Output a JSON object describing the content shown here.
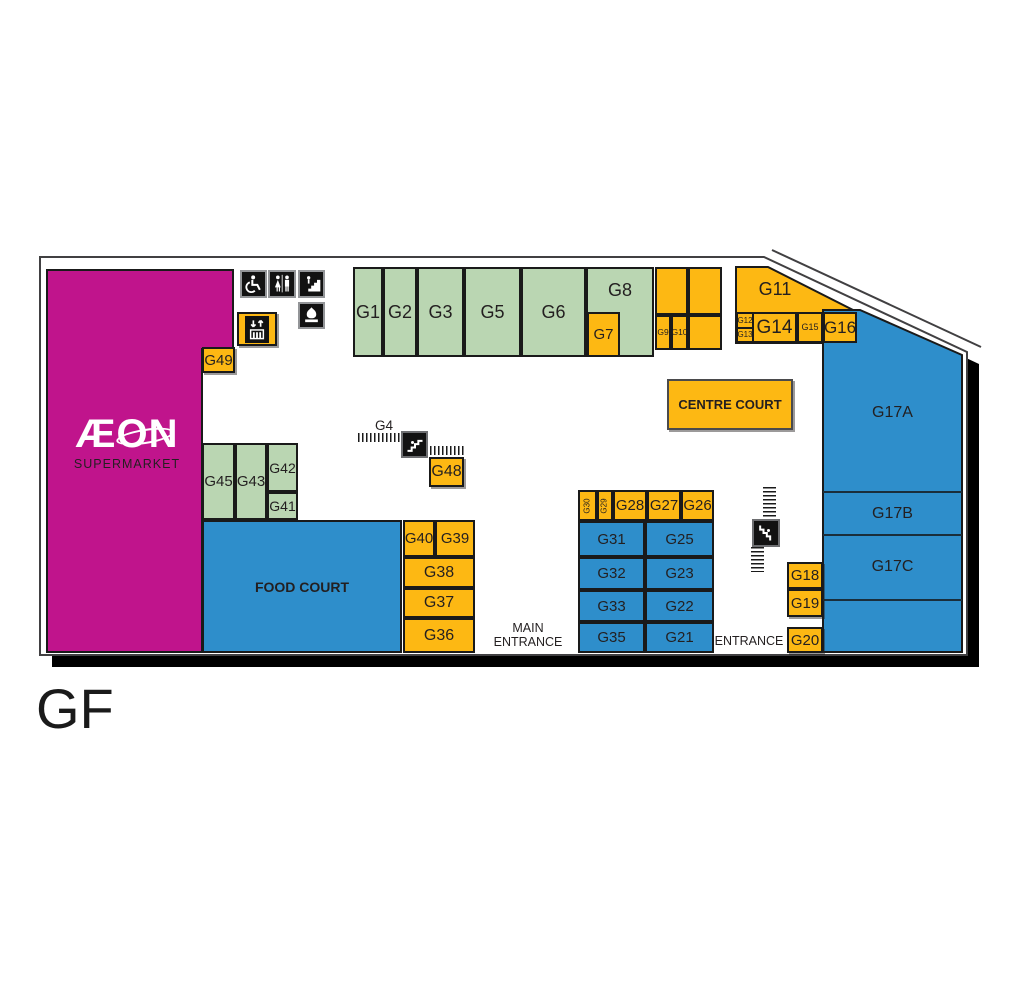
{
  "floor_label": "GF",
  "supermarket": {
    "brand": "ÆON",
    "subtitle": "SUPERMARKET"
  },
  "areas": {
    "food_court": "FOOD COURT",
    "centre_court": "CENTRE COURT"
  },
  "entrances": {
    "main_line1": "MAIN",
    "main_line2": "ENTRANCE",
    "side": "ENTRANCE"
  },
  "units": {
    "g1": "G1",
    "g2": "G2",
    "g3": "G3",
    "g4": "G4",
    "g5": "G5",
    "g6": "G6",
    "g7": "G7",
    "g8": "G8",
    "g9": "G9",
    "g10": "G10",
    "g11": "G11",
    "g12": "G12",
    "g13": "G13",
    "g14": "G14",
    "g15": "G15",
    "g16": "G16",
    "g17a": "G17A",
    "g17b": "G17B",
    "g17c": "G17C",
    "g18": "G18",
    "g19": "G19",
    "g20": "G20",
    "g21": "G21",
    "g22": "G22",
    "g23": "G23",
    "g25": "G25",
    "g26": "G26",
    "g27": "G27",
    "g28": "G28",
    "g29": "G29",
    "g30": "G30",
    "g31": "G31",
    "g32": "G32",
    "g33": "G33",
    "g35": "G35",
    "g36": "G36",
    "g37": "G37",
    "g38": "G38",
    "g39": "G39",
    "g40": "G40",
    "g41": "G41",
    "g42": "G42",
    "g43": "G43",
    "g45": "G45",
    "g48": "G48",
    "g49": "G49"
  },
  "icons": {
    "wheelchair": "wheelchair-accessible",
    "restrooms": "male-female-toilets",
    "stairs": "stairs",
    "prayer_room": "dome",
    "elevator": "lift-up-down-arrows",
    "escalator": "escalator-diagonal-steps"
  },
  "colors": {
    "supermarket_magenta": "#C0148C",
    "retail_yellow": "#FDB813",
    "retail_green": "#BAD6B2",
    "retail_blue": "#2E8ECB",
    "outline": "#414042",
    "icon_black": "#121212"
  }
}
